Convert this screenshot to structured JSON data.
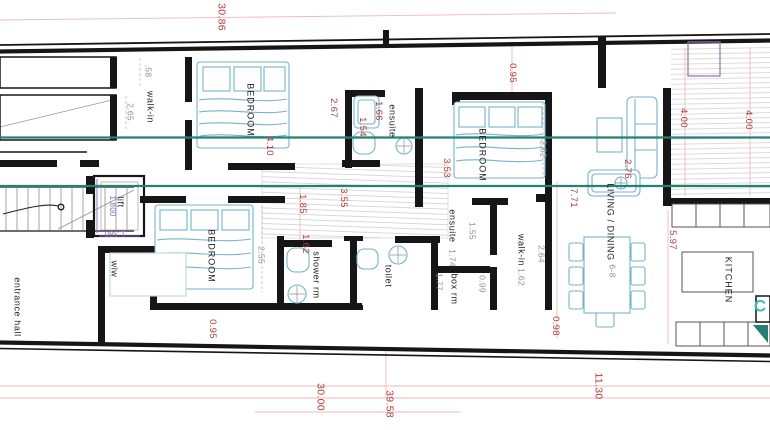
{
  "drawing": {
    "type": "architectural-floor-plan",
    "description": "apartment plan with three bedrooms, ensuites, living/dining, kitchen and terrace"
  },
  "colors": {
    "wall": "#161616",
    "section_line": "#1f8276",
    "furniture": "#74b3c9",
    "dim_red": "#b23a3a",
    "dim_gray": "#8f8f8f",
    "dim_purple": "#8767b8",
    "hatch": "#c9c9c9"
  },
  "layers": [
    {
      "name": "room-labels",
      "cls": "room",
      "items": [
        {
          "name": "room-label-walk-in-1",
          "text": "walk-in",
          "x": 150,
          "y": 107
        },
        {
          "name": "room-label-bedroom-1",
          "text": "BEDROOM",
          "x": 250,
          "y": 110,
          "ls": 1
        },
        {
          "name": "room-label-ensuite-1",
          "text": "ensuite",
          "x": 392,
          "y": 121
        },
        {
          "name": "room-label-bedroom-2",
          "text": "BEDROOM",
          "x": 482,
          "y": 155,
          "ls": 1
        },
        {
          "name": "room-label-bedroom-3",
          "text": "BEDROOM",
          "x": 211,
          "y": 256,
          "ls": 1
        },
        {
          "name": "room-label-shower-rm",
          "text": "shower rm",
          "x": 316,
          "y": 275
        },
        {
          "name": "room-label-toilet",
          "text": "toilet",
          "x": 388,
          "y": 276
        },
        {
          "name": "room-label-ensuite-2",
          "text": "ensuite",
          "x": 452,
          "y": 226
        },
        {
          "name": "room-label-box-rm",
          "text": "box rm",
          "x": 454,
          "y": 289
        },
        {
          "name": "room-label-walk-in-2",
          "text": "walk-in",
          "x": 521,
          "y": 250
        },
        {
          "name": "room-label-living-dining",
          "text": "LIVING / DINING",
          "x": 610,
          "y": 222
        },
        {
          "name": "room-label-kitchen",
          "text": "KITCHEN",
          "x": 728,
          "y": 280,
          "ls": 1
        },
        {
          "name": "room-label-entrance-hall",
          "text": "entrance hall",
          "x": 17,
          "y": 307
        },
        {
          "name": "room-label-wiw",
          "text": "wiw",
          "x": 114,
          "y": 269
        },
        {
          "name": "room-label-lift",
          "text": "lift",
          "x": 120,
          "y": 202
        }
      ]
    },
    {
      "name": "red-dimensions",
      "cls": "dim-red",
      "items": [
        {
          "name": "dim-30-86",
          "text": "30.86",
          "x": 221,
          "y": 17,
          "size": 10.5
        },
        {
          "name": "dim-0-95-top",
          "text": "0.95",
          "x": 512,
          "y": 73
        },
        {
          "name": "dim-2-67",
          "text": "2.67",
          "x": 333,
          "y": 108
        },
        {
          "name": "dim-1-66",
          "text": "1.66",
          "x": 378,
          "y": 111
        },
        {
          "name": "dim-1-54",
          "text": "1.54",
          "x": 362,
          "y": 127
        },
        {
          "name": "dim-4-10",
          "text": "4.10",
          "x": 269,
          "y": 146
        },
        {
          "name": "dim-3-53",
          "text": "3.53",
          "x": 446,
          "y": 168
        },
        {
          "name": "dim-3-55",
          "text": "3.55",
          "x": 343,
          "y": 198
        },
        {
          "name": "dim-1-85",
          "text": "1.85",
          "x": 302,
          "y": 204
        },
        {
          "name": "dim-1-62-red",
          "text": "1.62",
          "x": 305,
          "y": 244
        },
        {
          "name": "dim-7-71",
          "text": "7.71",
          "x": 573,
          "y": 198
        },
        {
          "name": "dim-2-76",
          "text": "2.76",
          "x": 627,
          "y": 169
        },
        {
          "name": "dim-4-00-a",
          "text": "4.00",
          "x": 683,
          "y": 118
        },
        {
          "name": "dim-4-00-b",
          "text": "4.00",
          "x": 748,
          "y": 120
        },
        {
          "name": "dim-5-97",
          "text": "5.97",
          "x": 672,
          "y": 240
        },
        {
          "name": "dim-0-98",
          "text": "0.98",
          "x": 555,
          "y": 326
        },
        {
          "name": "dim-0-95-bottom",
          "text": "0.95",
          "x": 212,
          "y": 329
        },
        {
          "name": "dim-30-00",
          "text": "30.00",
          "x": 320,
          "y": 397,
          "size": 10.5
        },
        {
          "name": "dim-39-58",
          "text": "39.58",
          "x": 389,
          "y": 404,
          "size": 10.5
        },
        {
          "name": "dim-11-30",
          "text": "11.30",
          "x": 598,
          "y": 386,
          "size": 10.5
        }
      ]
    },
    {
      "name": "gray-dimensions",
      "cls": "dim-gray",
      "items": [
        {
          "name": "dim-0-58",
          "text": ".58",
          "x": 148,
          "y": 71
        },
        {
          "name": "dim-2-65",
          "text": "2.65",
          "x": 130,
          "y": 112
        },
        {
          "name": "dim-2-62",
          "text": "2.62",
          "x": 543,
          "y": 149
        },
        {
          "name": "dim-2-55",
          "text": "2.55",
          "x": 261,
          "y": 255
        },
        {
          "name": "dim-1-55",
          "text": "1.55",
          "x": 472,
          "y": 231
        },
        {
          "name": "dim-0-99",
          "text": "0.99",
          "x": 482,
          "y": 284
        },
        {
          "name": "dim-1-77",
          "text": "1.77",
          "x": 439,
          "y": 282
        },
        {
          "name": "dim-2-64",
          "text": "2.64",
          "x": 541,
          "y": 254
        },
        {
          "name": "dim-1-74-ensuite",
          "text": "1.74",
          "x": 452,
          "y": 258
        },
        {
          "name": "dim-1-62-walkin",
          "text": "1.62",
          "x": 521,
          "y": 277
        },
        {
          "name": "dim-seats-6-8",
          "text": "6-8",
          "x": 612,
          "y": 271
        }
      ]
    },
    {
      "name": "purple-dimensions",
      "cls": "dim-purple",
      "items": [
        {
          "name": "dim-lift-1-800",
          "text": "1.800",
          "x": 112,
          "y": 206
        },
        {
          "name": "dim-lift-1-380",
          "text": "1.380",
          "x": 115,
          "y": 233,
          "rot": 180
        }
      ]
    },
    {
      "name": "annotations",
      "cls": "cyan-note",
      "items": [
        {
          "name": "kitchen-letter-c",
          "text": "C",
          "x": 760,
          "y": 306,
          "rot": 0
        }
      ]
    }
  ]
}
